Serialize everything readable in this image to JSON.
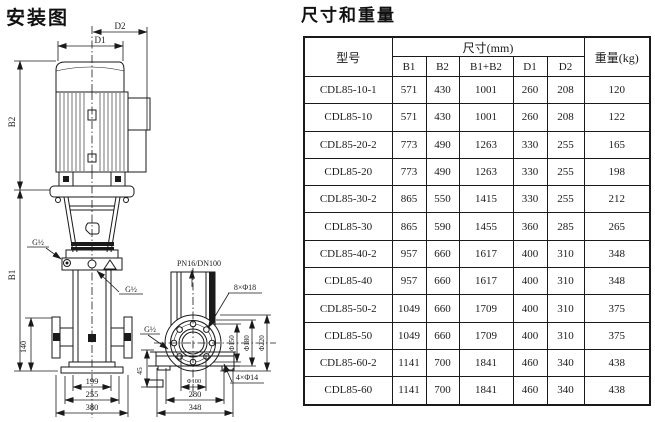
{
  "page": {
    "background": "#ffffff",
    "ink": "#1a1a1a"
  },
  "diagram": {
    "title": "安装图",
    "labels": {
      "d2": "D2",
      "d1": "D1",
      "b2": "B2",
      "b1": "B1",
      "g_top": "G½",
      "g_mid": "G½",
      "g_side": "G½",
      "pn": "PN16/DN100",
      "flange_bolts": "8×Φ18",
      "phi150": "Φ150",
      "phi180": "Φ180",
      "phi220": "Φ220",
      "phi100": "Φ100",
      "base_bolts": "4×Φ14",
      "h140": "140",
      "h45": "45",
      "w199": "199",
      "w255": "255",
      "w380": "380",
      "w280": "280",
      "w348": "348"
    }
  },
  "table": {
    "title": "尺寸和重量",
    "header": {
      "model": "型号",
      "dims_group": "尺寸(mm)",
      "weight": "重量(kg)",
      "cols": [
        "B1",
        "B2",
        "B1+B2",
        "D1",
        "D2"
      ]
    },
    "rows": [
      [
        "CDL85-10-1",
        "571",
        "430",
        "1001",
        "260",
        "208",
        "120"
      ],
      [
        "CDL85-10",
        "571",
        "430",
        "1001",
        "260",
        "208",
        "122"
      ],
      [
        "CDL85-20-2",
        "773",
        "490",
        "1263",
        "330",
        "255",
        "165"
      ],
      [
        "CDL85-20",
        "773",
        "490",
        "1263",
        "330",
        "255",
        "198"
      ],
      [
        "CDL85-30-2",
        "865",
        "550",
        "1415",
        "330",
        "255",
        "212"
      ],
      [
        "CDL85-30",
        "865",
        "590",
        "1455",
        "360",
        "285",
        "265"
      ],
      [
        "CDL85-40-2",
        "957",
        "660",
        "1617",
        "400",
        "310",
        "348"
      ],
      [
        "CDL85-40",
        "957",
        "660",
        "1617",
        "400",
        "310",
        "348"
      ],
      [
        "CDL85-50-2",
        "1049",
        "660",
        "1709",
        "400",
        "310",
        "375"
      ],
      [
        "CDL85-50",
        "1049",
        "660",
        "1709",
        "400",
        "310",
        "375"
      ],
      [
        "CDL85-60-2",
        "1141",
        "700",
        "1841",
        "460",
        "340",
        "438"
      ],
      [
        "CDL85-60",
        "1141",
        "700",
        "1841",
        "460",
        "340",
        "438"
      ]
    ]
  }
}
